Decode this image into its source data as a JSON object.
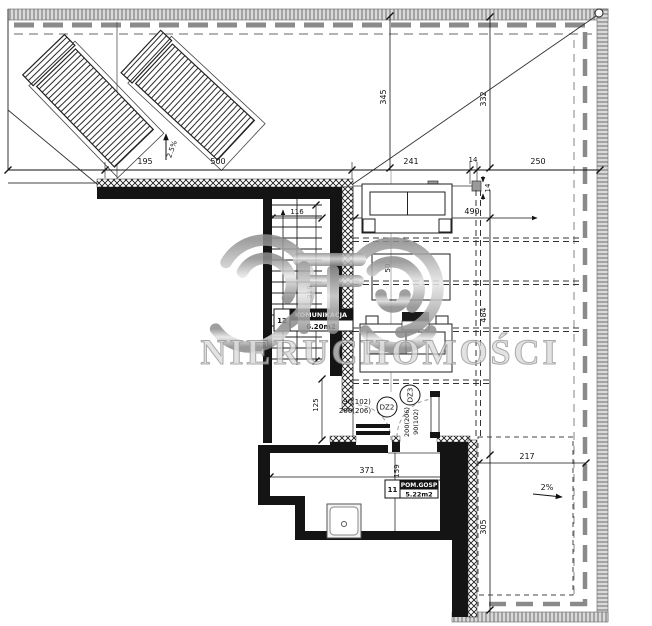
{
  "watermark": {
    "brand_text": "NIERUCHOMOŚCI"
  },
  "dimensions": {
    "d195": "195",
    "d500": "500",
    "d241": "241",
    "d14_top": "14",
    "d250": "250",
    "d345": "345",
    "d332": "332",
    "d14_side": "14",
    "d490": "490",
    "d484": "484",
    "d217": "217",
    "d305": "305",
    "d371": "371",
    "d159": "159",
    "d116": "116",
    "d319": "319",
    "d125": "125",
    "d50": "50"
  },
  "slopes": {
    "terrace_slope": "2.5%",
    "balcony_slope": "2%"
  },
  "rooms": {
    "komunikacja": {
      "number": "12",
      "name": "KOMUNIKACJA",
      "area": "6.20m2"
    },
    "pom_gosp": {
      "number": "11",
      "name": "POM.GOSP",
      "area": "5.22m2"
    }
  },
  "doors": {
    "dz2": {
      "code": "DZ2",
      "size_width": "90(102)",
      "size_height": "200(206)"
    },
    "dz3": {
      "code": "DZ3",
      "size_width": "90(102)",
      "size_height": "200(206)"
    }
  },
  "colors": {
    "line": "#1a1a1a",
    "hatch_gray": "#8a8a8a",
    "watermark_silver": "#b5b5b5"
  }
}
